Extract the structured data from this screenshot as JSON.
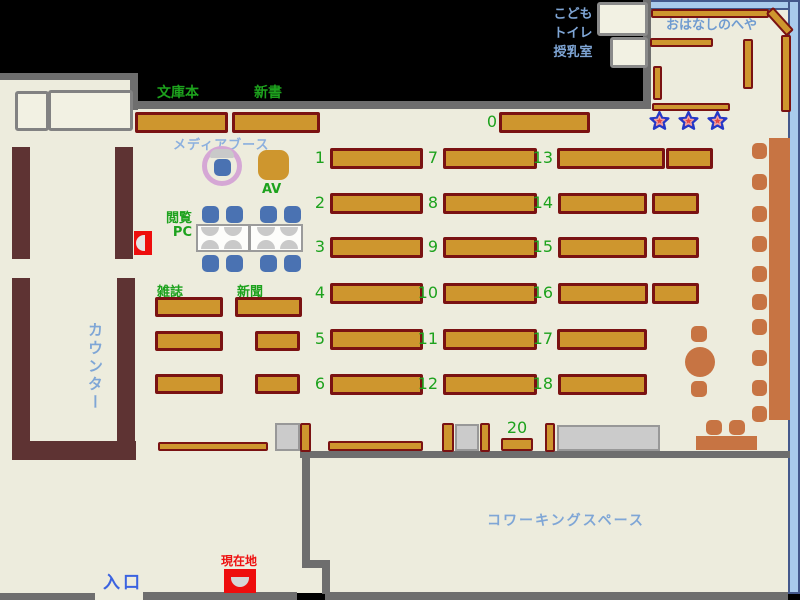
{
  "map": {
    "title": "library-floor-map",
    "labels": {
      "kids_lines": [
        "こども",
        "トイレ",
        "授乳室"
      ],
      "story_room": "おはなしのへや",
      "bunkobon": "文庫本",
      "shinsho": "新書",
      "media_booth": "メディアブース",
      "av": "AV",
      "pc_line1": "閲覧",
      "pc_line2": "PC",
      "magazines": "雑誌",
      "newspapers": "新聞",
      "counter": "カウンター",
      "coworking": "コワーキングスペース",
      "entrance": "入口",
      "current_location": "現在地"
    },
    "shelf_numbers": {
      "n0": "0",
      "n1": "1",
      "n2": "2",
      "n3": "3",
      "n4": "4",
      "n5": "5",
      "n6": "6",
      "n7": "7",
      "n8": "8",
      "n9": "9",
      "n10": "10",
      "n11": "11",
      "n12": "12",
      "n13": "13",
      "n14": "14",
      "n15": "15",
      "n16": "16",
      "n17": "17",
      "n18": "18",
      "n20": "20"
    },
    "colors": {
      "floor": "#EDECDD",
      "shelf_orange": "#CE962E",
      "shelf_border_red": "#7A1212",
      "wall_gray": "#6E6E6E",
      "counter_maroon": "#5E3333",
      "furniture_terracotta": "#C77443",
      "chair_blue": "#4A72B2",
      "label_green": "#1DA21D",
      "label_lightblue": "#7FA6D6",
      "entrance_blue": "#3B63E0",
      "alert_red": "#EE0D0D",
      "room_border_blue": "#A9CBEC",
      "star_red": "#E44848",
      "star_outline_blue": "#2438C8",
      "booth_ring_pink": "#D5A7D5"
    }
  }
}
